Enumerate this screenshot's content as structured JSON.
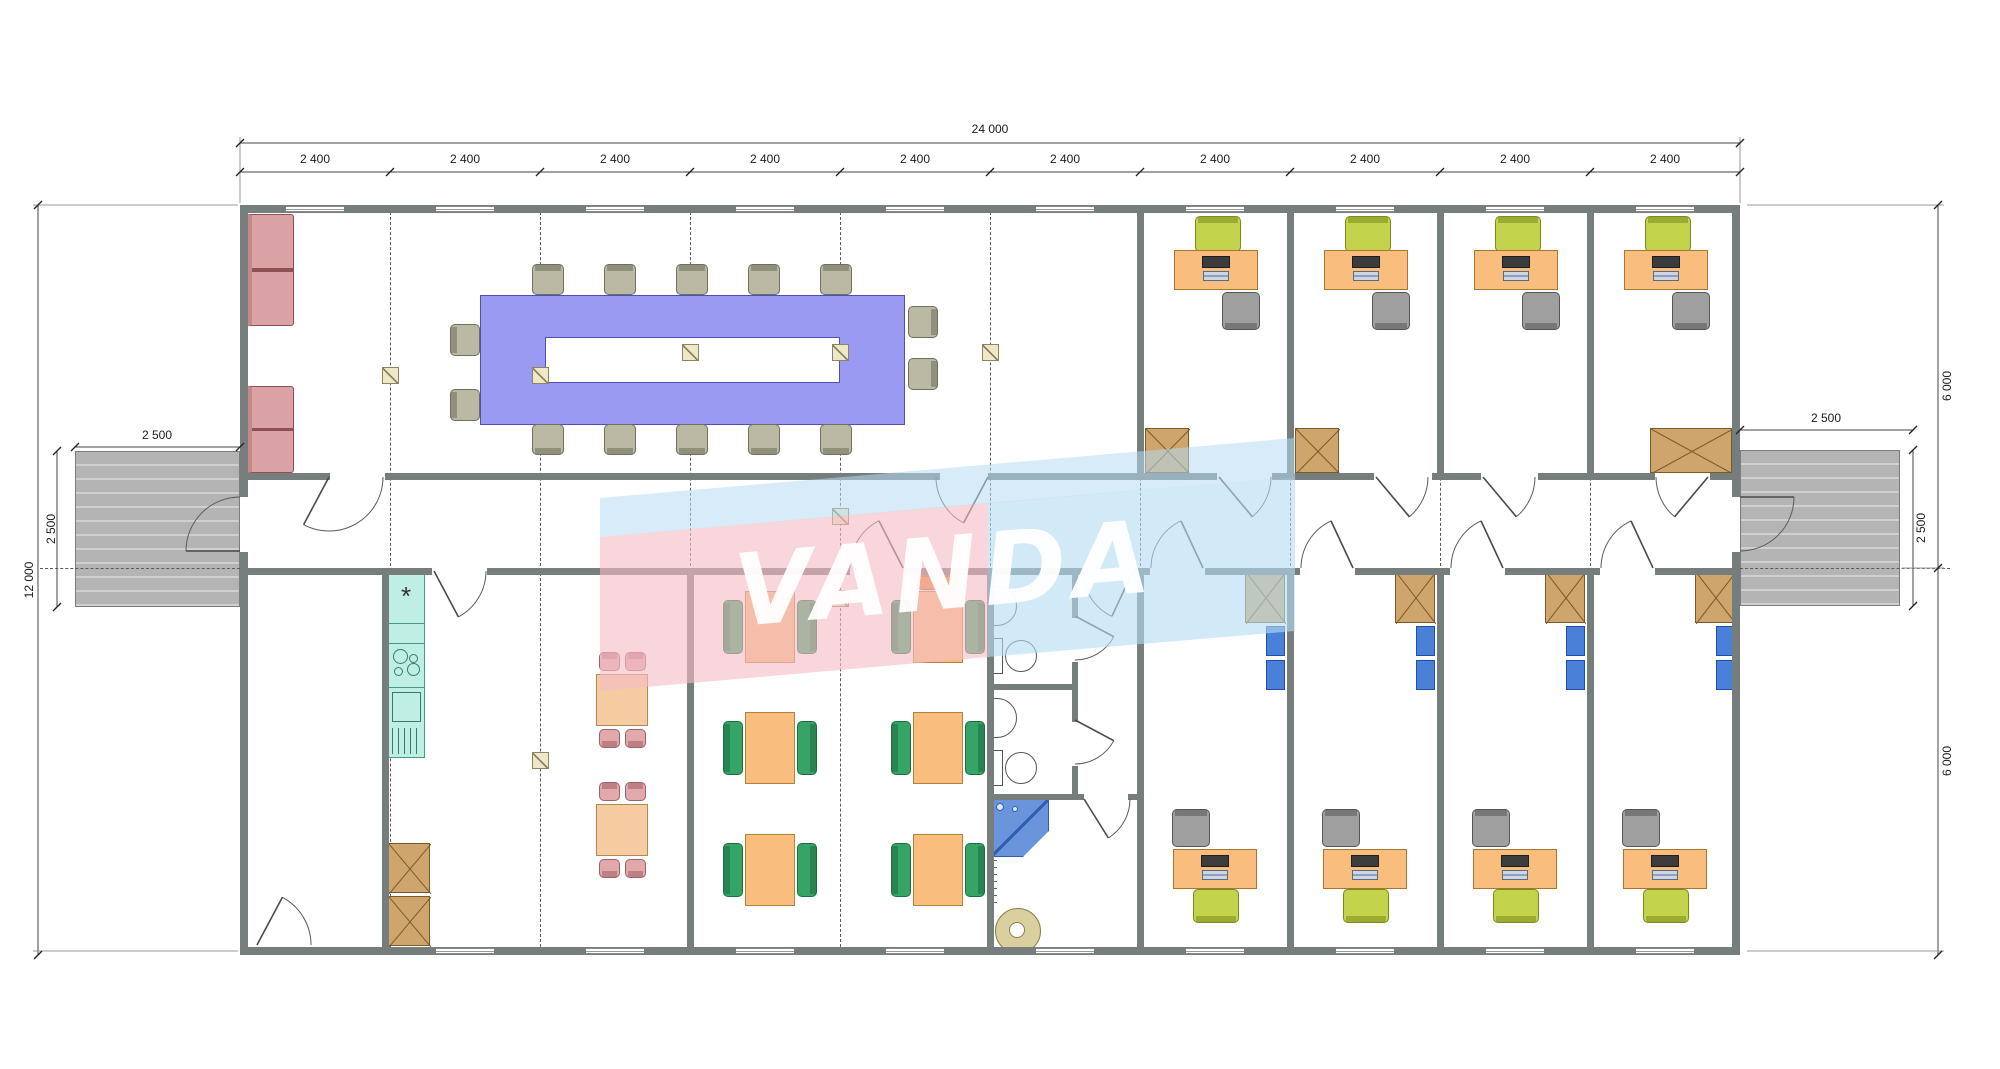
{
  "watermark": {
    "text": "VANDA",
    "pink": "#f3bdc6",
    "blue": "#b7dbf2"
  },
  "dimensions": {
    "overall_width": "24 000",
    "module": "2 400",
    "module_count": 10,
    "overall_height": "12 000",
    "porch_left_width": "2 500",
    "porch_left_depth": "2 500",
    "porch_right_width": "2 500",
    "porch_right_depth": "2 500",
    "right_upper_half": "6 000",
    "right_lower_half": "6 000"
  },
  "kitchen": {
    "hood_symbol": "*"
  },
  "colors": {
    "wall": "#767d7d",
    "conference_table": "#9a9af2",
    "sofa": "#dba2a6",
    "desk": "#f9be7e",
    "task_chair_green": "#c3d34b",
    "office_chair_gray": "#9f9f9f",
    "meeting_chair": "#b9b9a4",
    "canteen_chair": "#36a367",
    "canteen_accent_chair": "#f08a3c",
    "dining_chair_pink": "#e2a9ad",
    "dining_table": "#f6cba2",
    "kitchen_unit": "#bfeee4",
    "cabinet": "#cda56d",
    "shelf_blue": "#4a80d8",
    "shower": "#6a95dd",
    "washer": "#d9cf9f",
    "deck": "#b4b4b4"
  }
}
